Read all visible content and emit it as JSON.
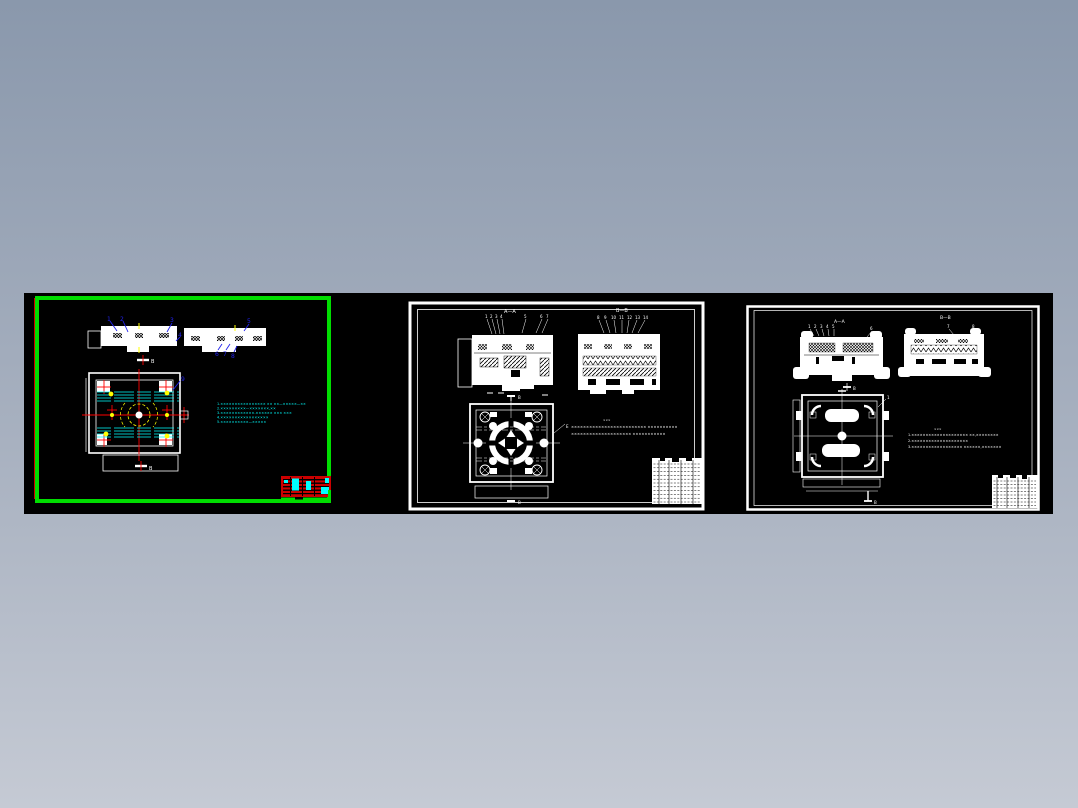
{
  "scene": {
    "type": "cad-preview-filmstrip",
    "background_top": "#8a98ac",
    "background_bottom": "#c5cad4",
    "filmstrip_color": "#000000",
    "sheet_count": "3"
  },
  "sheet1": {
    "selected": true,
    "frame_color": "#00dd00",
    "line_color": "#ffffff",
    "center_line_color": "#ff0000",
    "hidden_line_color": "#00ffff",
    "detail_color": "#ffff00",
    "callout_color": "#2222ee",
    "title_block_color": "#cc0000",
    "callouts": [
      "1",
      "2",
      "3",
      "4",
      "5",
      "6",
      "7",
      "8"
    ],
    "plan_callout": "9",
    "section_top": "B",
    "section_bottom": "B",
    "notes": [
      "1.×××××××××××××××× ×× ××—×××××—××",
      "2.×××××××××—×××××××,××",
      "3.××××××××××××-×××××× ××× ×××",
      "4.×××××××××××××××××",
      "5.××××××××××—×××××"
    ]
  },
  "sheet2": {
    "selected": false,
    "frame_color": "#ffffff",
    "line_color": "#ffffff",
    "view_title_left": "A—A",
    "view_title_right": "B—B",
    "callouts_left": [
      "1",
      "2",
      "3",
      "4",
      "5",
      "6",
      "7"
    ],
    "callouts_right": [
      "8",
      "9",
      "10",
      "11",
      "12",
      "13",
      "14"
    ],
    "section_top": "B",
    "section_bottom": "B",
    "leader_label": "E",
    "notes_header": "×××",
    "notes": [
      "××××××××××××××××××××××××× ××××××××××",
      "×××××××××××××××××××× ×××××××××××"
    ]
  },
  "sheet3": {
    "selected": false,
    "frame_color": "#ffffff",
    "line_color": "#ffffff",
    "view_title_left": "A—A",
    "view_title_right": "B—B",
    "callouts_left": [
      "1",
      "2",
      "3",
      "4",
      "5"
    ],
    "callout_mid": "6",
    "callouts_right": [
      "7",
      "8"
    ],
    "section_mid": "B",
    "section_bottom": "B",
    "plan_callout": "1",
    "notes_header": "×××",
    "notes": [
      "1.×××××××××××××××××××× ××,××××××××",
      "2.××××××××××××××××××××",
      "3.×××××××××××××××××× ××××××,×××××××"
    ]
  }
}
